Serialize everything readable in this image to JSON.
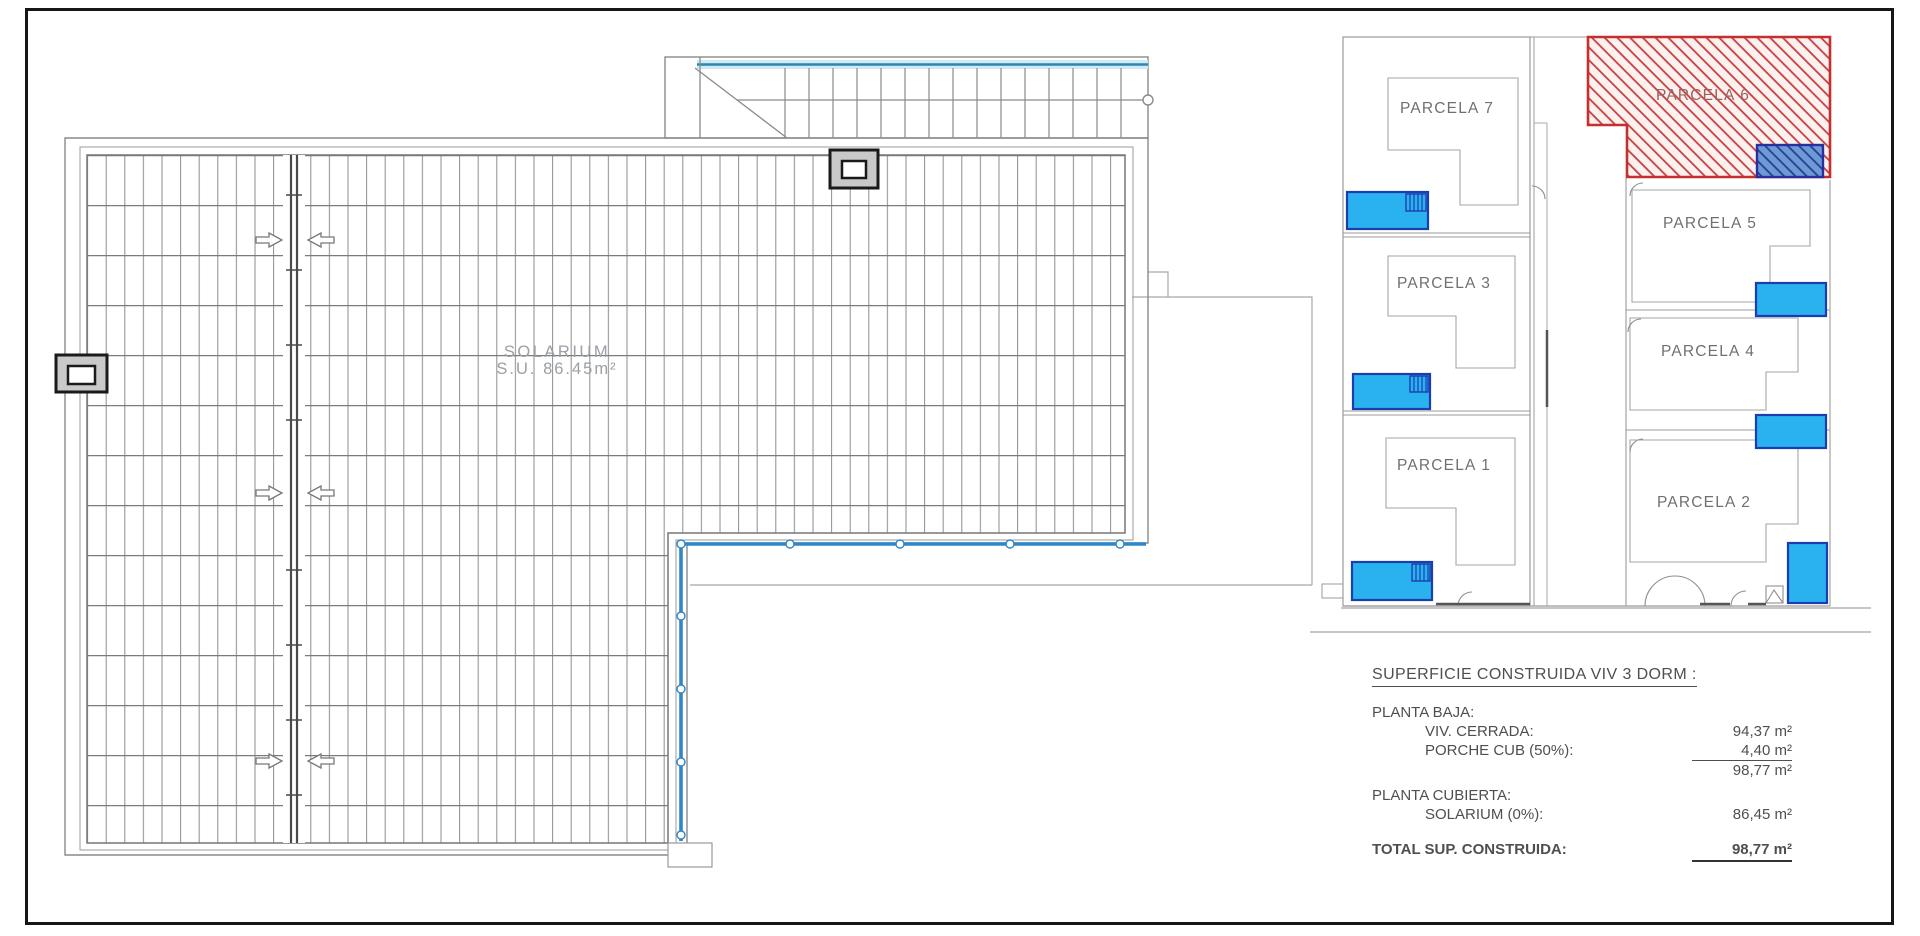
{
  "plan": {
    "solarium_label": "SOLARIUM",
    "solarium_area": "S.U. 86.45m²"
  },
  "site_plan": {
    "parcels": [
      {
        "id": "parcela-7",
        "label": "PARCELA 7"
      },
      {
        "id": "parcela-3",
        "label": "PARCELA 3"
      },
      {
        "id": "parcela-1",
        "label": "PARCELA 1"
      },
      {
        "id": "parcela-6",
        "label": "PARCELA 6",
        "highlighted": true
      },
      {
        "id": "parcela-5",
        "label": "PARCELA 5"
      },
      {
        "id": "parcela-4",
        "label": "PARCELA 4"
      },
      {
        "id": "parcela-2",
        "label": "PARCELA 2"
      }
    ],
    "highlight_color": "#c5302e",
    "pool_color": "#29b2ef",
    "balustrade_color": "#2f86c8"
  },
  "summary": {
    "title": "SUPERFICIE CONSTRUIDA VIV 3 DORM :",
    "planta_baja_label": "PLANTA BAJA:",
    "viv_cerrada_label": "VIV. CERRADA:",
    "viv_cerrada_value": "94,37 m²",
    "porche_label": "PORCHE CUB (50%):",
    "porche_value": "4,40 m²",
    "planta_baja_subtotal": "98,77 m²",
    "planta_cubierta_label": "PLANTA CUBIERTA:",
    "solarium_row_label": "SOLARIUM (0%):",
    "solarium_row_value": "86,45 m²",
    "total_label": "TOTAL SUP. CONSTRUIDA:",
    "total_value": "98,77 m²"
  }
}
